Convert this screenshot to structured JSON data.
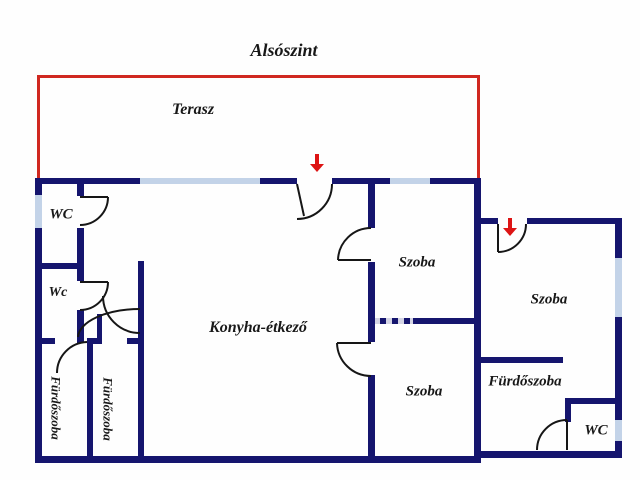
{
  "title": "Alsószint",
  "colors": {
    "bg": "#fefefe",
    "wall": "#15156e",
    "window": "#c3d3e8",
    "terrace": "#d02820",
    "arrow": "#dd1414",
    "door": "#161616",
    "text": "#181818"
  },
  "labels": [
    {
      "id": "plan-title",
      "text": "Alsószint",
      "x": 284,
      "y": 50,
      "size": 18,
      "rot": 0
    },
    {
      "id": "terasz",
      "text": "Terasz",
      "x": 193,
      "y": 110,
      "size": 16,
      "rot": 0
    },
    {
      "id": "wc-upper-left",
      "text": "WC",
      "x": 61,
      "y": 215,
      "size": 15,
      "rot": 0
    },
    {
      "id": "wc-lower-left",
      "text": "Wc",
      "x": 58,
      "y": 293,
      "size": 14,
      "rot": 0
    },
    {
      "id": "furdoszoba-left-outer",
      "text": "Fürdőszoba",
      "x": 56,
      "y": 408,
      "size": 13,
      "rot": 90
    },
    {
      "id": "furdoszoba-left-inner",
      "text": "Fürdőszoba",
      "x": 108,
      "y": 409,
      "size": 13,
      "rot": 90
    },
    {
      "id": "konyha-etkezo",
      "text": "Konyha-étkező",
      "x": 258,
      "y": 328,
      "size": 16,
      "rot": 0
    },
    {
      "id": "szoba-middle-top",
      "text": "Szoba",
      "x": 417,
      "y": 263,
      "size": 15,
      "rot": 0
    },
    {
      "id": "szoba-middle-bottom",
      "text": "Szoba",
      "x": 424,
      "y": 392,
      "size": 15,
      "rot": 0
    },
    {
      "id": "szoba-right",
      "text": "Szoba",
      "x": 549,
      "y": 300,
      "size": 15,
      "rot": 0
    },
    {
      "id": "furdoszoba-right",
      "text": "Fürdőszoba",
      "x": 525,
      "y": 382,
      "size": 15,
      "rot": 0
    },
    {
      "id": "wc-right",
      "text": "WC",
      "x": 596,
      "y": 431,
      "size": 15,
      "rot": 0
    }
  ],
  "terrace_lines": [
    {
      "x": 37,
      "y": 75,
      "w": 443,
      "h": 3
    },
    {
      "x": 37,
      "y": 75,
      "w": 3,
      "h": 103
    },
    {
      "x": 477,
      "y": 75,
      "w": 3,
      "h": 109
    }
  ],
  "walls": [
    {
      "x": 35,
      "y": 178,
      "w": 105,
      "h": 6
    },
    {
      "x": 260,
      "y": 178,
      "w": 37,
      "h": 6
    },
    {
      "x": 332,
      "y": 178,
      "w": 58,
      "h": 6
    },
    {
      "x": 430,
      "y": 178,
      "w": 51,
      "h": 6
    },
    {
      "x": 35,
      "y": 178,
      "w": 7,
      "h": 285
    },
    {
      "x": 35,
      "y": 456,
      "w": 446,
      "h": 7
    },
    {
      "x": 478,
      "y": 451,
      "w": 144,
      "h": 7
    },
    {
      "x": 474,
      "y": 178,
      "w": 7,
      "h": 280
    },
    {
      "x": 77,
      "y": 184,
      "w": 7,
      "h": 12
    },
    {
      "x": 77,
      "y": 228,
      "w": 7,
      "h": 35
    },
    {
      "x": 35,
      "y": 263,
      "w": 49,
      "h": 6
    },
    {
      "x": 77,
      "y": 269,
      "w": 7,
      "h": 12
    },
    {
      "x": 77,
      "y": 310,
      "w": 7,
      "h": 33
    },
    {
      "x": 35,
      "y": 338,
      "w": 20,
      "h": 6
    },
    {
      "x": 87,
      "y": 338,
      "w": 15,
      "h": 6
    },
    {
      "x": 127,
      "y": 338,
      "w": 17,
      "h": 6
    },
    {
      "x": 87,
      "y": 338,
      "w": 6,
      "h": 125
    },
    {
      "x": 138,
      "y": 261,
      "w": 6,
      "h": 202
    },
    {
      "x": 368,
      "y": 178,
      "w": 7,
      "h": 50
    },
    {
      "x": 368,
      "y": 262,
      "w": 7,
      "h": 80
    },
    {
      "x": 368,
      "y": 375,
      "w": 7,
      "h": 88
    },
    {
      "x": 413,
      "y": 318,
      "w": 67,
      "h": 6
    },
    {
      "x": 368,
      "y": 318,
      "w": 46,
      "h": 6,
      "dashed": true
    },
    {
      "x": 478,
      "y": 218,
      "w": 20,
      "h": 6
    },
    {
      "x": 527,
      "y": 218,
      "w": 95,
      "h": 6
    },
    {
      "x": 615,
      "y": 218,
      "w": 7,
      "h": 240
    },
    {
      "x": 478,
      "y": 357,
      "w": 85,
      "h": 6
    },
    {
      "x": 565,
      "y": 398,
      "w": 57,
      "h": 6
    },
    {
      "x": 565,
      "y": 398,
      "w": 6,
      "h": 24
    },
    {
      "x": 79,
      "y": 316,
      "w": 5,
      "h": 24
    },
    {
      "x": 97,
      "y": 314,
      "w": 5,
      "h": 26
    }
  ],
  "windows": [
    {
      "x": 140,
      "y": 178,
      "w": 120,
      "h": 6
    },
    {
      "x": 390,
      "y": 178,
      "w": 40,
      "h": 6
    },
    {
      "x": 35,
      "y": 195,
      "w": 7,
      "h": 33
    },
    {
      "x": 615,
      "y": 258,
      "w": 7,
      "h": 59
    },
    {
      "x": 615,
      "y": 420,
      "w": 7,
      "h": 21
    }
  ],
  "doors": [
    {
      "id": "door-main-entrance",
      "d": "M332,184 A35,35 0 0 1 297,219 M297,184 L304,216"
    },
    {
      "id": "door-wc-upper-left",
      "d": "M80,197 L108,197 M108,197 A28,28 0 0 1 80,225"
    },
    {
      "id": "door-wc-lower-left",
      "d": "M80,282 L108,282 M108,282 A28,28 0 0 1 80,310"
    },
    {
      "id": "door-furdoszoba-left-outer",
      "d": "M87,342 A31,31 0 0 0 57,373"
    },
    {
      "id": "door-furdoszoba-left-inner",
      "d": "M103,296 A37,37 0 0 0 140,333"
    },
    {
      "id": "door-corridor",
      "d": "M78,337 A62,29 0 0 1 140,309"
    },
    {
      "id": "door-szoba-top",
      "d": "M338,260 L371,260 M338,260 A33,33 0 0 1 371,228"
    },
    {
      "id": "door-szoba-bottom",
      "d": "M337,343 L371,343 M337,343 A34,34 0 0 0 371,376"
    },
    {
      "id": "door-right-entrance",
      "d": "M498,224 L498,252 M498,252 A28,28 0 0 0 526,224"
    },
    {
      "id": "door-wc-right",
      "d": "M567,420 L567,450 M567,420 A30,30 0 0 0 537,450"
    }
  ],
  "arrows": [
    {
      "id": "entrance-arrow-main",
      "cx": 317,
      "y1": 154,
      "y2": 172
    },
    {
      "id": "entrance-arrow-right",
      "cx": 510,
      "y1": 218,
      "y2": 236
    }
  ]
}
